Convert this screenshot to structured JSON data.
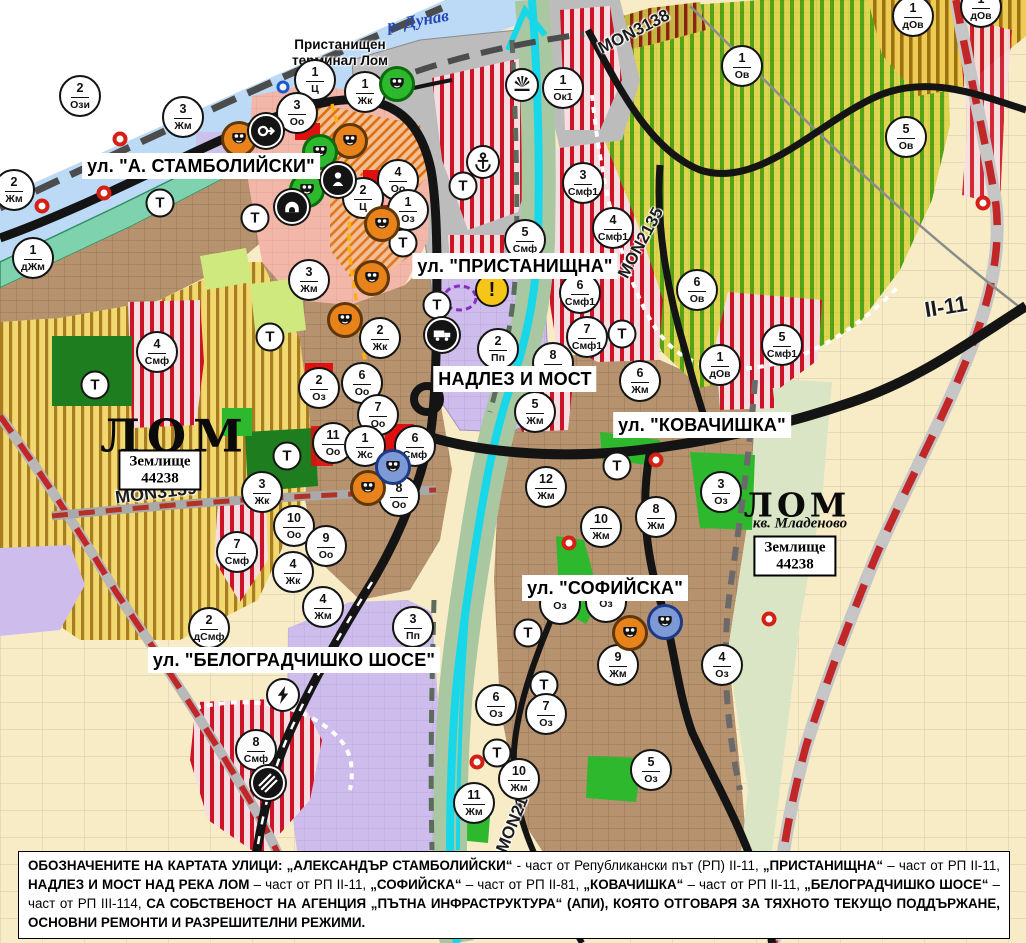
{
  "palette": {
    "water": "#bcd9f5",
    "shore_green": "#7fd2ae",
    "cyan_river": "#17d7e8",
    "farm_yellow_stripe": "#a87c20",
    "vineyard_green": "#57a317",
    "red_stripe": "#cd1326",
    "lavender": "#cdbcec",
    "urban_brown": "#b6926e",
    "park_green": "#2eb82e",
    "dark_forest": "#1e7d1e",
    "road_black": "#141414",
    "dashed_red": "#c22728",
    "mask_orange": "#e8821a",
    "warning_yellow": "#f5c518"
  },
  "street_labels": [
    {
      "t": "ул. \"А. СТАМБОЛИЙСКИ\"",
      "x": 201,
      "y": 166
    },
    {
      "t": "ул. \"ПРИСТАНИЩНА\"",
      "x": 515,
      "y": 266
    },
    {
      "t": "НАДЛЕЗ И МОСТ",
      "x": 515,
      "y": 379
    },
    {
      "t": "ул. \"КОВАЧИШКА\"",
      "x": 702,
      "y": 425
    },
    {
      "t": "ул. \"СОФИЙСКА\"",
      "x": 605,
      "y": 588
    },
    {
      "t": "ул. \"БЕЛОГРАДЧИШКО ШОСЕ\"",
      "x": 294,
      "y": 660
    }
  ],
  "road_labels": [
    {
      "t": "MON3138",
      "x": 634,
      "y": 32,
      "r": -27,
      "s": 17
    },
    {
      "t": "MON2135",
      "x": 641,
      "y": 243,
      "r": -62,
      "s": 17
    },
    {
      "t": "MON3139",
      "x": 156,
      "y": 493,
      "r": -7,
      "s": 18
    },
    {
      "t": "MON2136",
      "x": 516,
      "y": 816,
      "r": -68,
      "s": 17
    },
    {
      "t": "II-11",
      "x": 946,
      "y": 307,
      "r": -9,
      "s": 22
    }
  ],
  "places": {
    "r_dunav": {
      "t": "р. Дунав",
      "x": 418,
      "y": 21,
      "r": -10
    },
    "terminal": {
      "l1": "Пристанищен",
      "l2": "терминал Лом",
      "x": 340,
      "y": 53
    },
    "lom_west": {
      "t": "ЛОМ",
      "x": 175,
      "y": 436
    },
    "zem_west": {
      "l1": "Землище",
      "l2": "44238",
      "x": 160,
      "y": 470
    },
    "lom_east": {
      "t": "ЛОМ",
      "x": 797,
      "y": 505
    },
    "kv_mladenovo": {
      "t": "кв. Младеново",
      "x": 800,
      "y": 524
    },
    "zem_east": {
      "l1": "Землище",
      "l2": "44238",
      "x": 795,
      "y": 556
    }
  },
  "t_label": "Т",
  "warning_glyph": "!",
  "zone_markers": [
    {
      "x": 80,
      "y": 96,
      "n": "2",
      "c": "Ози"
    },
    {
      "x": 315,
      "y": 80,
      "n": "1",
      "c": "Ц"
    },
    {
      "x": 365,
      "y": 92,
      "n": "1",
      "c": "Жк"
    },
    {
      "x": 297,
      "y": 113,
      "n": "3",
      "c": "Оо"
    },
    {
      "x": 183,
      "y": 117,
      "n": "3",
      "c": "Жм"
    },
    {
      "x": 563,
      "y": 88,
      "n": "1",
      "c": "Ок1"
    },
    {
      "x": 14,
      "y": 190,
      "n": "2",
      "c": "Жм"
    },
    {
      "x": 33,
      "y": 258,
      "n": "1",
      "c": "дЖм"
    },
    {
      "x": 398,
      "y": 180,
      "n": "4",
      "c": "Оо"
    },
    {
      "x": 363,
      "y": 198,
      "n": "2",
      "c": "Ц"
    },
    {
      "x": 408,
      "y": 210,
      "n": "1",
      "c": "Оз"
    },
    {
      "x": 309,
      "y": 280,
      "n": "3",
      "c": "Жм"
    },
    {
      "x": 913,
      "y": 16,
      "n": "1",
      "c": "дОв"
    },
    {
      "x": 981,
      "y": 7,
      "n": "1",
      "c": "дОв"
    },
    {
      "x": 742,
      "y": 66,
      "n": "1",
      "c": "Ов"
    },
    {
      "x": 906,
      "y": 137,
      "n": "5",
      "c": "Ов"
    },
    {
      "x": 583,
      "y": 183,
      "n": "3",
      "c": "Смф1"
    },
    {
      "x": 613,
      "y": 228,
      "n": "4",
      "c": "Смф1"
    },
    {
      "x": 580,
      "y": 293,
      "n": "6",
      "c": "Смф1"
    },
    {
      "x": 587,
      "y": 337,
      "n": "7",
      "c": "Смф1"
    },
    {
      "x": 782,
      "y": 345,
      "n": "5",
      "c": "Смф1"
    },
    {
      "x": 697,
      "y": 290,
      "n": "6",
      "c": "Ов"
    },
    {
      "x": 720,
      "y": 365,
      "n": "1",
      "c": "дОв"
    },
    {
      "x": 525,
      "y": 240,
      "n": "5",
      "c": "Смф"
    },
    {
      "x": 498,
      "y": 349,
      "n": "2",
      "c": "Пп"
    },
    {
      "x": 553,
      "y": 363,
      "n": "8",
      "c": "Жм"
    },
    {
      "x": 535,
      "y": 412,
      "n": "5",
      "c": "Жм"
    },
    {
      "x": 640,
      "y": 381,
      "n": "6",
      "c": "Жм"
    },
    {
      "x": 546,
      "y": 487,
      "n": "12",
      "c": "Жм"
    },
    {
      "x": 601,
      "y": 527,
      "n": "10",
      "c": "Жм"
    },
    {
      "x": 656,
      "y": 517,
      "n": "8",
      "c": "Жм"
    },
    {
      "x": 721,
      "y": 492,
      "n": "3",
      "c": "Оз"
    },
    {
      "x": 380,
      "y": 338,
      "n": "2",
      "c": "Жк"
    },
    {
      "x": 362,
      "y": 383,
      "n": "6",
      "c": "Оо"
    },
    {
      "x": 319,
      "y": 388,
      "n": "2",
      "c": "Оз"
    },
    {
      "x": 378,
      "y": 415,
      "n": "7",
      "c": "Оо"
    },
    {
      "x": 333,
      "y": 443,
      "n": "11",
      "c": "Оо"
    },
    {
      "x": 365,
      "y": 446,
      "n": "1",
      "c": "Жс"
    },
    {
      "x": 415,
      "y": 446,
      "n": "6",
      "c": "Смф"
    },
    {
      "x": 399,
      "y": 496,
      "n": "8",
      "c": "Оо"
    },
    {
      "x": 262,
      "y": 492,
      "n": "3",
      "c": "Жк"
    },
    {
      "x": 294,
      "y": 526,
      "n": "10",
      "c": "Оо"
    },
    {
      "x": 326,
      "y": 546,
      "n": "9",
      "c": "Оо"
    },
    {
      "x": 293,
      "y": 572,
      "n": "4",
      "c": "Жк"
    },
    {
      "x": 237,
      "y": 552,
      "n": "7",
      "c": "Смф"
    },
    {
      "x": 157,
      "y": 352,
      "n": "4",
      "c": "Смф"
    },
    {
      "x": 209,
      "y": 628,
      "n": "2",
      "c": "дСмф"
    },
    {
      "x": 323,
      "y": 607,
      "n": "4",
      "c": "Жм"
    },
    {
      "x": 413,
      "y": 627,
      "n": "3",
      "c": "Пп"
    },
    {
      "x": 256,
      "y": 750,
      "n": "8",
      "c": "Смф"
    },
    {
      "x": 618,
      "y": 665,
      "n": "9",
      "c": "Жм"
    },
    {
      "x": 722,
      "y": 665,
      "n": "4",
      "c": "Оз"
    },
    {
      "x": 496,
      "y": 705,
      "n": "6",
      "c": "Оз"
    },
    {
      "x": 546,
      "y": 714,
      "n": "7",
      "c": "Оз"
    },
    {
      "x": 651,
      "y": 770,
      "n": "5",
      "c": "Оз"
    },
    {
      "x": 519,
      "y": 779,
      "n": "10",
      "c": "Жм"
    },
    {
      "x": 474,
      "y": 803,
      "n": "11",
      "c": "Жм"
    },
    {
      "x": 560,
      "y": 604,
      "n": "",
      "c": "Оз"
    },
    {
      "x": 606,
      "y": 602,
      "n": "",
      "c": "Оз"
    }
  ],
  "t_markers": [
    {
      "x": 160,
      "y": 203
    },
    {
      "x": 255,
      "y": 218
    },
    {
      "x": 403,
      "y": 243
    },
    {
      "x": 463,
      "y": 186
    },
    {
      "x": 95,
      "y": 385
    },
    {
      "x": 270,
      "y": 337
    },
    {
      "x": 287,
      "y": 456
    },
    {
      "x": 437,
      "y": 305
    },
    {
      "x": 622,
      "y": 334
    },
    {
      "x": 617,
      "y": 466
    },
    {
      "x": 528,
      "y": 633
    },
    {
      "x": 544,
      "y": 685
    },
    {
      "x": 497,
      "y": 753
    }
  ],
  "icon_markers": [
    {
      "type": "theater-mask-orange",
      "x": 239,
      "y": 139
    },
    {
      "type": "theater-mask-orange",
      "x": 350,
      "y": 141
    },
    {
      "type": "theater-mask-orange",
      "x": 382,
      "y": 224
    },
    {
      "type": "theater-mask-orange",
      "x": 372,
      "y": 278
    },
    {
      "type": "theater-mask-orange",
      "x": 345,
      "y": 320
    },
    {
      "type": "theater-mask-orange",
      "x": 368,
      "y": 488
    },
    {
      "type": "theater-mask-orange",
      "x": 630,
      "y": 633
    },
    {
      "type": "theater-mask-green",
      "x": 397,
      "y": 84
    },
    {
      "type": "theater-mask-green",
      "x": 320,
      "y": 152
    },
    {
      "type": "theater-mask-green",
      "x": 307,
      "y": 190
    },
    {
      "type": "theater-mask-blue",
      "x": 393,
      "y": 467
    },
    {
      "type": "theater-mask-blue",
      "x": 665,
      "y": 622
    },
    {
      "type": "ring-arrow",
      "x": 266,
      "y": 131
    },
    {
      "type": "monument",
      "x": 338,
      "y": 180
    },
    {
      "type": "cave",
      "x": 292,
      "y": 207
    },
    {
      "type": "anchor",
      "x": 483,
      "y": 162
    },
    {
      "type": "crane",
      "x": 522,
      "y": 85
    },
    {
      "type": "warning",
      "x": 492,
      "y": 290
    },
    {
      "type": "truck",
      "x": 442,
      "y": 335
    },
    {
      "type": "bolt",
      "x": 283,
      "y": 695
    },
    {
      "type": "rail-crossing",
      "x": 268,
      "y": 783
    },
    {
      "type": "blue-ring",
      "x": 283,
      "y": 87
    },
    {
      "type": "red-dot",
      "x": 42,
      "y": 206
    },
    {
      "type": "red-dot",
      "x": 104,
      "y": 193
    },
    {
      "type": "red-dot",
      "x": 120,
      "y": 139
    },
    {
      "type": "red-dot",
      "x": 656,
      "y": 460
    },
    {
      "type": "red-dot",
      "x": 569,
      "y": 543
    },
    {
      "type": "red-dot",
      "x": 477,
      "y": 762
    },
    {
      "type": "red-dot",
      "x": 769,
      "y": 619
    },
    {
      "type": "red-dot",
      "x": 983,
      "y": 203
    }
  ],
  "footer": {
    "segments": [
      {
        "t": "ОБОЗНАЧЕНИТЕ НА КАРТАТА УЛИЦИ: ",
        "b": 1
      },
      {
        "t": "„АЛЕКСАНДЪР СТАМБОЛИЙСКИ“",
        "b": 1
      },
      {
        "t": " - част от Републикански път (РП) II-11, ",
        "b": 0
      },
      {
        "t": "„ПРИСТАНИЩНА“",
        "b": 1
      },
      {
        "t": " – част от РП II-11, ",
        "b": 0
      },
      {
        "t": "НАДЛЕЗ И МОСТ НАД РЕКА ЛОМ",
        "b": 1
      },
      {
        "t": " – част от РП II-11, ",
        "b": 0
      },
      {
        "t": "„СОФИЙСКА“",
        "b": 1
      },
      {
        "t": " – част от РП II-81, ",
        "b": 0
      },
      {
        "t": "„КОВАЧИШКА“",
        "b": 1
      },
      {
        "t": " – част от РП II-11, ",
        "b": 0
      },
      {
        "t": "„БЕЛОГРАДЧИШКО ШОСЕ“",
        "b": 1
      },
      {
        "t": " – част от РП III-114, ",
        "b": 0
      },
      {
        "t": "СА СОБСТВЕНОСТ НА АГЕНЦИЯ „ПЪТНА ИНФРАСТРУКТУРА“ (АПИ), КОЯТО ОТГОВАРЯ ЗА ТЯХНОТО ТЕКУЩО ПОДДЪРЖАНЕ, ОСНОВНИ РЕМОНТИ И РАЗРЕШИТЕЛНИ РЕЖИМИ.",
        "b": 1
      }
    ]
  }
}
